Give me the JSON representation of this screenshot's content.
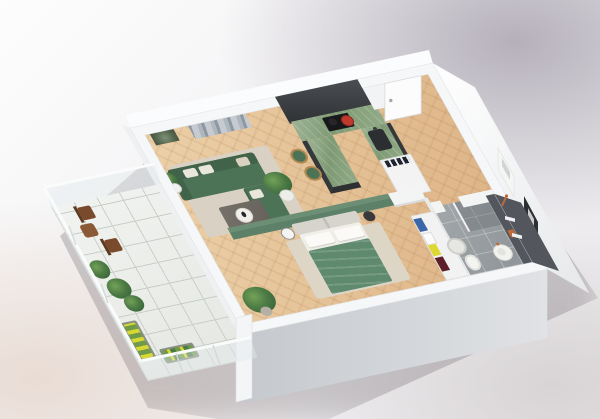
{
  "meta": {
    "title": "3D isometric cutaway render of a one-bedroom apartment floor plan",
    "image_width": 600,
    "image_height": 419,
    "view": "axonometric from upper left, no text labels visible"
  },
  "palette": {
    "bg_top_right": "#b5b0ba",
    "bg_bottom_left": "#e9dcd4",
    "bg_bottom_right": "#d8d4d5",
    "wall_white": "#f6f7f8",
    "wall_band": "#eceef0",
    "wall_face_left": "#c5c9cd",
    "wall_face_right": "#e0e2e5",
    "parquet": "#ecd0a8",
    "parquet_dark": "#dcb284",
    "bath_tile": "#a3a8ab",
    "bath_tile_dark": "#8e9397",
    "balcony_tile": "#e4e7e2",
    "balcony_grid": "#c8cdc7",
    "accent_green_wall": "#5d8168",
    "sofa_green": "#4d7356",
    "sofa_green_dark": "#41634a",
    "duvet_green": "#5f8a6e",
    "counter_marble": "#7e9a74",
    "cabinet_dark": "#3c4043",
    "alcove_dark": "#45494d",
    "accent_wall_dark": "#53575d",
    "headboard_gray": "#d7d4cd",
    "rug_living": "#d8d1c4",
    "rug_bedroom": "#ddd6c7",
    "wood_brown": "#7a4a2c",
    "wood_table": "#8a5a36",
    "brass": "#b08850",
    "copper": "#c06a3a",
    "red_pot": "#c0392e",
    "cloth_blue": "#3b66a8",
    "cloth_yellow": "#ded832",
    "cloth_red": "#5f1f29",
    "flower_yellow": "#d8d832",
    "plant_green": "#4e7c46",
    "plant_dark": "#2f5c33",
    "window_glass": "#ccd6d8",
    "poster_dark": "#2d2f33",
    "cushion_white": "#e9e6dc"
  },
  "apartment": {
    "rooms": [
      {
        "name": "living-room",
        "floor": "herringbone parquet",
        "features": [
          "green sectional sofa with chaise",
          "white and beige throw pillows",
          "dark coffee table with round white tray",
          "beige area rug",
          "snake plant on white stand",
          "large potted plant in white pot",
          "small botanical wall art",
          "large gray abstract wall art",
          "glass balcony door"
        ]
      },
      {
        "name": "kitchen",
        "floor": "herringbone parquet",
        "features": [
          "charcoal tall cabinet alcove",
          "green marble U-shaped counter",
          "black cooktop with red pot",
          "dark sink with faucet",
          "two green bar stools with brass legs",
          "white open shelf unit with dark dishware"
        ]
      },
      {
        "name": "entry-hall",
        "floor": "herringbone parquet",
        "features": [
          "white front door with handle",
          "white poster on wall",
          "black poster on wall",
          "white wall column"
        ]
      },
      {
        "name": "bedroom",
        "floor": "herringbone parquet",
        "features": [
          "sage green accent wall",
          "double bed with two-panel gray upholstered headboard",
          "two white pillows",
          "green duvet",
          "round white nightstand",
          "round black nightstand",
          "light rug",
          "large potted plant",
          "open wardrobe with folded clothes stacks colored blue, white, yellow and dark red"
        ]
      },
      {
        "name": "bathroom",
        "floor": "large gray tiles",
        "features": [
          "dark gray accent wall",
          "two white wall shelves",
          "walk-in shower with glass panel",
          "copper shower fixture",
          "white mesh laundry basket",
          "toilet",
          "round pedestal basin",
          "orange towel"
        ]
      },
      {
        "name": "balcony",
        "floor": "light tile grid",
        "features": [
          "glass railing with white handrail",
          "two dark wood folding chairs",
          "round wooden side table",
          "three leafy potted plants",
          "flower box with yellow flowers",
          "second planter box"
        ]
      }
    ]
  }
}
